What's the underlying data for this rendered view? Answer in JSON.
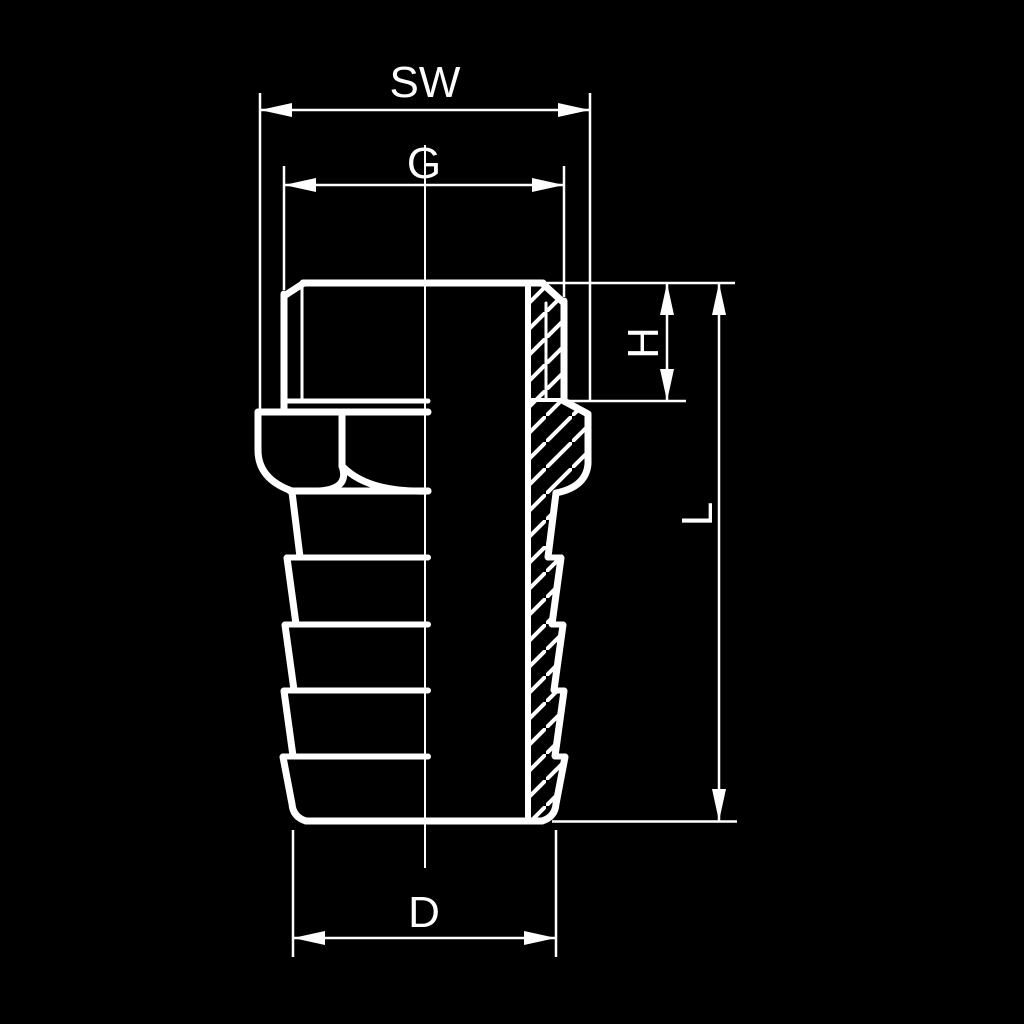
{
  "drawing": {
    "kind": "technical-drawing",
    "description": "Hose barb fitting with male thread and hex, left half outside view, right half section with hatching",
    "dimension_labels": {
      "sw": "SW",
      "g": "G",
      "h": "H",
      "l": "L",
      "d": "D"
    },
    "colors": {
      "background": "#000000",
      "line": "#ffffff"
    }
  }
}
